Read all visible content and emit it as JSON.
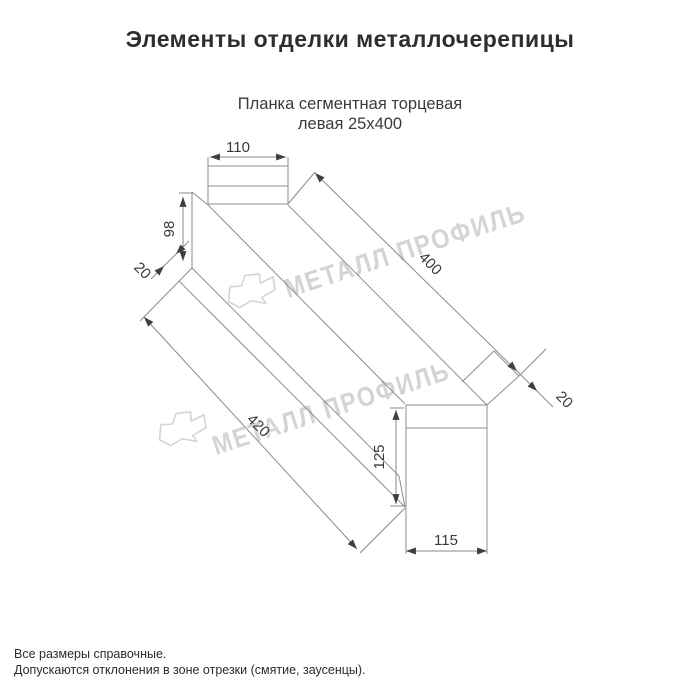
{
  "page": {
    "title": "Элементы отделки металлочерепицы",
    "subtitle_line1": "Планка сегментная торцевая",
    "subtitle_line2": "левая 25х400"
  },
  "drawing": {
    "part": "Планка сегментная торцевая левая",
    "dimensions": {
      "top_width": "110",
      "left_height": "98",
      "left_flange": "20",
      "length_top": "400",
      "length_bottom": "420",
      "right_flange": "20",
      "end_height": "125",
      "end_width": "115"
    }
  },
  "watermark": {
    "text": "МЕТАЛЛ ПРОФИЛЬ"
  },
  "footnotes": {
    "line1": "Все размеры справочные.",
    "line2": "Допускаются отклонения в зоне отрезки (смятие, заусенцы)."
  },
  "colors": {
    "background": "#ffffff",
    "part_line": "#8e8e8e",
    "dimension": "#3a3a3a",
    "watermark": "#d4d4d4",
    "title": "#2e2e2e"
  }
}
